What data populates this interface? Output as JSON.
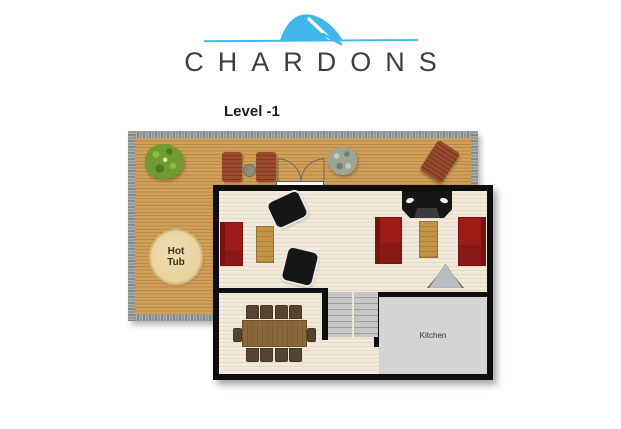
{
  "brand": {
    "name": "CHARDONS"
  },
  "plan": {
    "level_label": "Level -1",
    "hot_tub_label": "Hot Tub",
    "kitchen_label": "Kitchen"
  },
  "colors": {
    "brand-blue": "#41b6e8",
    "brand-text": "#3f3f3f",
    "deck-wood": "#d2a158",
    "deck-wood-line": "#b8894a",
    "deck-edge-gray": "#909aa4",
    "deck-edge-tan": "#c0ab8c",
    "floor-cream": "#f1e9da",
    "floor-line": "#e5dac5",
    "wall-black": "#0e0e0e",
    "sofa-red": "#9c1d17",
    "sofa-red-dark": "#7a120e",
    "table-wood": "#c2954a",
    "dining-wood": "#8a683c",
    "chair-brown": "#574430",
    "deck-chair-brown": "#9c4a2c",
    "kitchen-gray": "#d4d4d4",
    "stairs-gray": "#c6c6c6",
    "hot-tub-fill": "#e9d2a0",
    "bush-green": "#6e9c31",
    "plant-gray": "#9da695",
    "fireplace-gray": "#b9bdc2",
    "fireplace-brown": "#7a4a28",
    "black-furniture": "#161616"
  }
}
